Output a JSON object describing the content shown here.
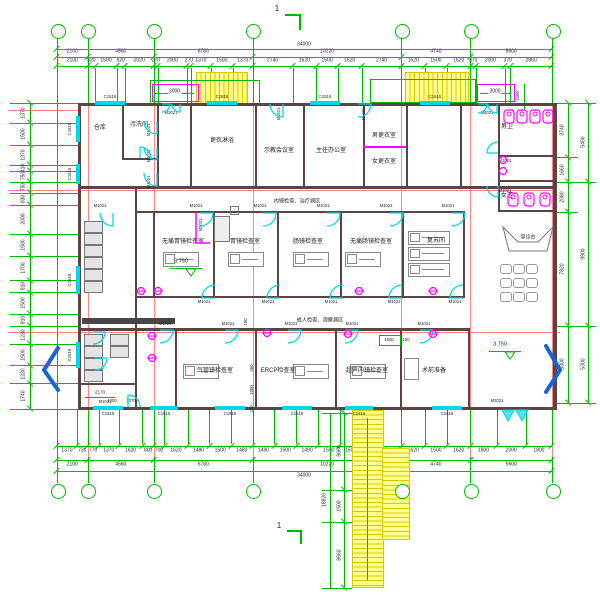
{
  "grid": {
    "bubbles": [
      "1",
      "2",
      "3",
      "4",
      "5",
      "6",
      "7"
    ]
  },
  "section_mark": "1",
  "level_marker": "3.750",
  "openings": {
    "window": "C1515",
    "door_single": "M1021",
    "door_double": "M2021"
  },
  "dims": {
    "overall": "34000",
    "bottom_overall": "34000",
    "top_segments": [
      "2100",
      "4560",
      "6780",
      "10220",
      "4740",
      "5600"
    ],
    "top_detail": [
      "2100",
      "520",
      "1500",
      "520",
      "2020",
      "270",
      "2000",
      "270",
      "1370",
      "1500",
      "1370",
      "2740",
      "1620",
      "1500",
      "1620",
      "2740",
      "1620",
      "1500",
      "1620",
      "370",
      "2000",
      "370",
      "2860"
    ],
    "bottom_detail": [
      "1370",
      "730",
      "770",
      "1370",
      "1620",
      "800",
      "700",
      "1620",
      "1480",
      "1500",
      "1480",
      "1490",
      "1500",
      "1490",
      "1500",
      "1500",
      "2740",
      "1620",
      "1500",
      "1620",
      "1800",
      "2000",
      "1800"
    ],
    "bottom_segments": [
      "2100",
      "4560",
      "6780",
      "10220",
      "4740",
      "5600"
    ],
    "left": [
      "1370",
      "1500",
      "1370",
      "410",
      "750",
      "750",
      "830",
      "2000",
      "1500",
      "1700",
      "810",
      "1500",
      "810",
      "1230",
      "1500",
      "1230",
      "1740"
    ],
    "right_inner": [
      "3740",
      "1660",
      "2080",
      "7820",
      "5300"
    ],
    "right_outer": [
      "5400",
      "9900",
      "5300"
    ],
    "stair_col": [
      "8660",
      "1500",
      "8660"
    ],
    "stair_total": "18820",
    "landing_left": "3000",
    "landing_right": "3000",
    "misc": {
      "m1560": "1560",
      "m2170": "2170",
      "m1000a": "1000",
      "m1070": "1070",
      "m460": "460",
      "m1000b": "1000",
      "m230": "230",
      "m150a": "150",
      "m1000c": "1000",
      "m150b": "150"
    }
  },
  "rooms": [
    {
      "name": "storage",
      "label": "仓库"
    },
    {
      "name": "soiled-washroom",
      "label": "污洗间"
    },
    {
      "name": "changing-shower",
      "label": "更衣淋浴"
    },
    {
      "name": "demo-meeting-room",
      "label": "示教会议室"
    },
    {
      "name": "director-office",
      "label": "主任办公室"
    },
    {
      "name": "male-changing-room",
      "label": "男更衣室"
    },
    {
      "name": "female-changing-room",
      "label": "女更衣室"
    },
    {
      "name": "male-toilet",
      "label": "男卫"
    },
    {
      "name": "female-toilet",
      "label": "女卫"
    },
    {
      "name": "painless-gastroscopy-room",
      "label": "无痛胃镜检查室"
    },
    {
      "name": "gastroscopy-room",
      "label": "胃镜检查室"
    },
    {
      "name": "colonoscopy-room",
      "label": "肠镜检查室"
    },
    {
      "name": "painless-colonoscopy-room",
      "label": "无痛肠镜检查室"
    },
    {
      "name": "recovery-room",
      "label": "复苏间"
    },
    {
      "name": "bronchoscopy-room",
      "label": "气管镜检查室"
    },
    {
      "name": "ercp-room",
      "label": "ERCP检查室"
    },
    {
      "name": "endoscopic-ultrasound-room",
      "label": "超声内镜检查室"
    },
    {
      "name": "preop-prep-room",
      "label": "术前准备"
    },
    {
      "name": "guide-desk",
      "label": "导诊台"
    }
  ],
  "corridors": {
    "upper": "内镜检查、治疗病区",
    "lower": "成人检查、观察病区"
  }
}
